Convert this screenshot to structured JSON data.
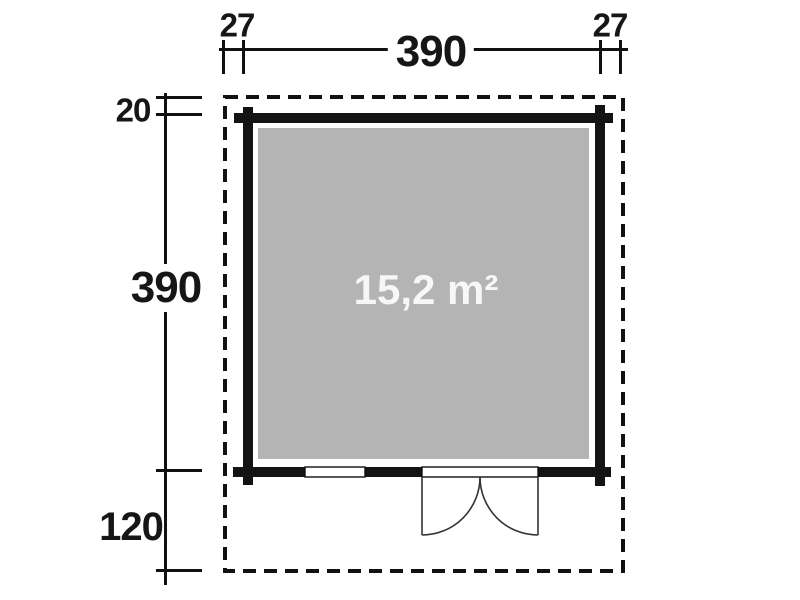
{
  "plan": {
    "area_label": "15,2 m²",
    "dimensions": {
      "top_left_overhang": "27",
      "top_width": "390",
      "top_right_overhang": "27",
      "side_top_offset": "20",
      "side_height": "390",
      "side_bottom_depth": "120"
    },
    "symbols": {
      "outline": "roof-overhang-dashed-outline",
      "walls": "log-wall-with-corner-joints",
      "door": "double-door-swing-symbol",
      "window": "window-symbol"
    },
    "colors": {
      "line": "#111111",
      "wall": "#141414",
      "floor_fill": "#b4b4b4",
      "area_text": "#f7f7f7",
      "background": "#ffffff"
    }
  }
}
